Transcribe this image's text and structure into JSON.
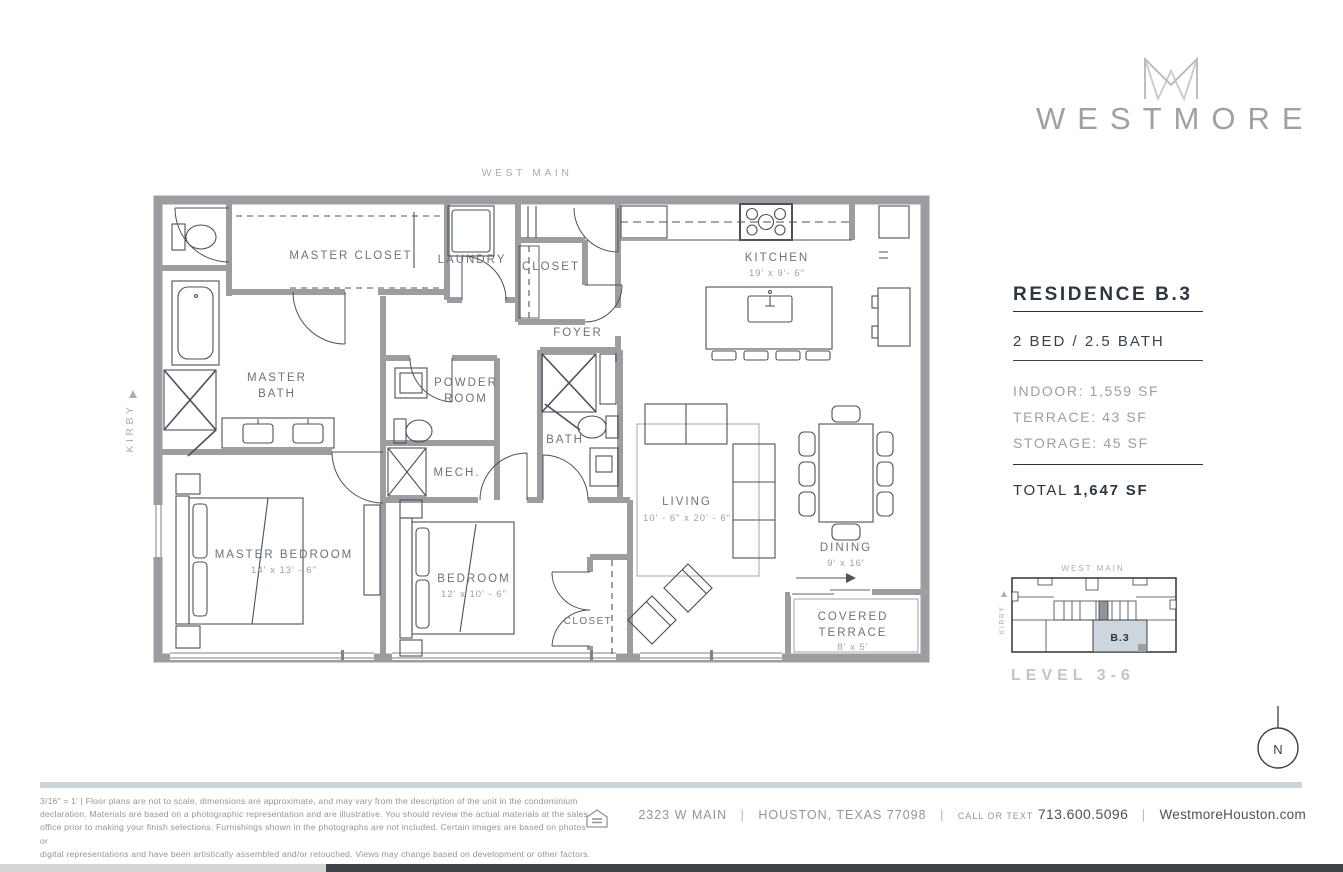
{
  "brand": {
    "wordmark": "WESTMORE"
  },
  "floorplan": {
    "street_top": "WEST MAIN",
    "street_left": "KIRBY",
    "labels": {
      "master_closet": "MASTER CLOSET",
      "laundry": "LAUNDRY",
      "hall_closet": "CLOSET",
      "kitchen": "KITCHEN",
      "kitchen_dims": "19'  x  9'- 6\"",
      "foyer": "FOYER",
      "master_bath_1": "MASTER",
      "master_bath_2": "BATH",
      "powder_1": "POWDER",
      "powder_2": "ROOM",
      "bath": "BATH",
      "mech": "MECH.",
      "living": "LIVING",
      "living_dims": "10' - 6\" x  20' - 6\"",
      "dining": "DINING",
      "dining_dims": "9'  x  16'",
      "master_bedroom": "MASTER BEDROOM",
      "master_bedroom_dims": "14'  x  13' - 6\"",
      "bedroom": "BEDROOM",
      "bedroom_dims": "12'  x  10' - 6\"",
      "bedroom_closet": "CLOSET",
      "terrace_1": "COVERED",
      "terrace_2": "TERRACE",
      "terrace_dims": "8' x 5'"
    }
  },
  "info_panel": {
    "residence": "RESIDENCE B.3",
    "beds_baths": "2 BED / 2.5 BATH",
    "indoor": "INDOOR: 1,559 SF",
    "terrace": "TERRACE: 43 SF",
    "storage": "STORAGE: 45 SF",
    "total_label": "TOTAL",
    "total_value": "1,647 SF"
  },
  "site_plan": {
    "street_top": "WEST MAIN",
    "street_left": "KIRBY",
    "unit_label": "B.3",
    "level_label": "LEVEL 3-6"
  },
  "compass": {
    "north_label": "N"
  },
  "footer": {
    "disclaimer": [
      "3/16\" = 1'    |    Floor plans are not to scale, dimensions are approximate, and may vary from the description of the unit in the condominium",
      "declaration. Materials are based on a photographic representation and are illustrative. You should review the actual materials at the sales",
      "office prior to making your finish selections. Furnishings shown in the photographs are not included. Certain images are based on photos or",
      "digital representations and have been artistically assembled and/or retouched. Views may change based on development or other factors."
    ],
    "address": "2323 W MAIN",
    "separator": "|",
    "city": "HOUSTON, TEXAS 77098",
    "call_label": "CALL OR TEXT",
    "phone": "713.600.5096",
    "website": "WestmoreHouston.com"
  },
  "colors": {
    "wall": "#9b9da0",
    "accent_fill": "#cdd6dc",
    "dark_text": "#2b3640"
  }
}
